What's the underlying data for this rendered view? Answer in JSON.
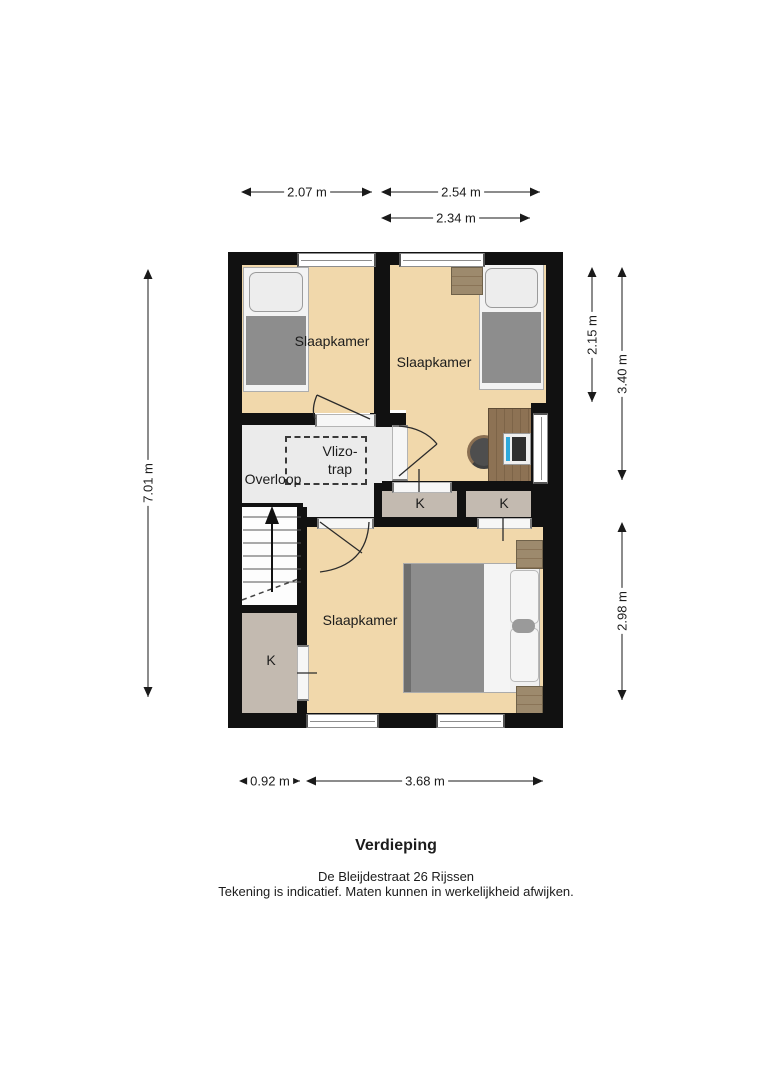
{
  "plan": {
    "rooms": {
      "bedroom_top_left": "Slaapkamer",
      "bedroom_top_right": "Slaapkamer",
      "bedroom_bottom": "Slaapkamer",
      "landing": "Overloop",
      "attic_ladder": [
        "Vlizo-",
        "trap"
      ],
      "closet_1": "K",
      "closet_2": "K",
      "closet_3": "K"
    },
    "dimensions": {
      "top": [
        "2.07 m",
        "2.54 m",
        "2.34 m"
      ],
      "left": [
        "7.01 m"
      ],
      "right": [
        "2.15 m",
        "3.40 m",
        "2.98 m"
      ],
      "bottom": [
        "0.92 m",
        "3.68 m"
      ]
    },
    "colors": {
      "wall": "#111111",
      "room_floor": "#f1d8ab",
      "landing_floor": "#ebebeb",
      "closet_floor": "#c3bab0",
      "furniture_wood": "#9d8a6d",
      "bed_blanket": "#8d8d8d",
      "laptop_accent": "#2ea9dc"
    }
  },
  "footer": {
    "title": "Verdieping",
    "address": "De Bleijdestraat 26 Rijssen",
    "disclaimer": "Tekening is indicatief. Maten kunnen in werkelijkheid afwijken."
  }
}
